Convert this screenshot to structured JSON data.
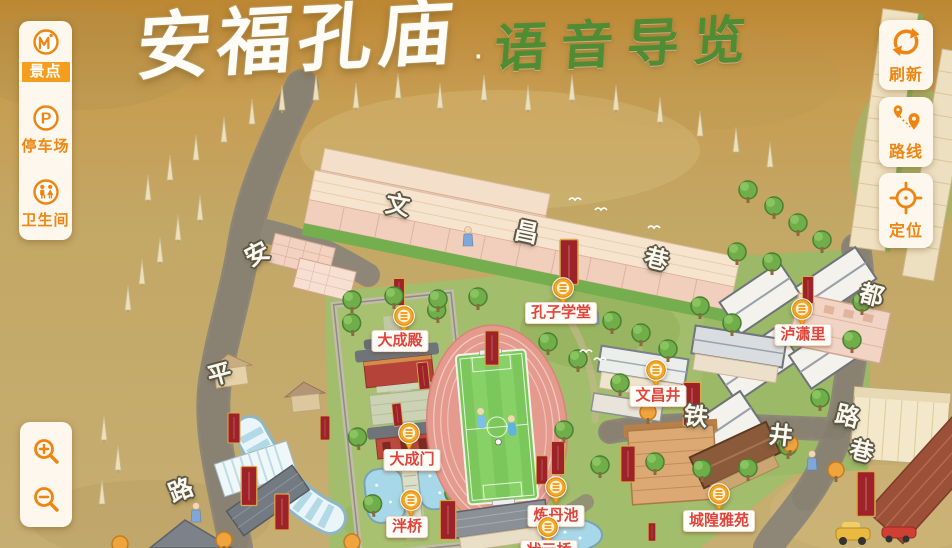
{
  "title": {
    "main": "安福孔庙",
    "separator": "·",
    "subtitle": "语音导览"
  },
  "left_toolbar": {
    "items": [
      {
        "label": "景点",
        "icon": "scenic-spot-icon",
        "active": true
      },
      {
        "label": "停车场",
        "icon": "parking-icon",
        "active": false
      },
      {
        "label": "卫生间",
        "icon": "restroom-icon",
        "active": false
      }
    ]
  },
  "right_toolbar": {
    "items": [
      {
        "label": "刷新",
        "icon": "refresh-icon"
      },
      {
        "label": "路线",
        "icon": "route-icon"
      },
      {
        "label": "定位",
        "icon": "locate-icon"
      }
    ]
  },
  "zoom_controls": {
    "items": [
      {
        "icon": "zoom-in-icon"
      },
      {
        "icon": "zoom-out-icon"
      }
    ]
  },
  "map": {
    "pois": [
      {
        "name": "大成殿",
        "marker_x": 404,
        "marker_y": 320,
        "label_x": 400,
        "label_y": 330
      },
      {
        "name": "孔子学堂",
        "marker_x": 563,
        "marker_y": 292,
        "label_x": 561,
        "label_y": 302
      },
      {
        "name": "大成门",
        "marker_x": 409,
        "marker_y": 437,
        "label_x": 412,
        "label_y": 449
      },
      {
        "name": "泮桥",
        "marker_x": 411,
        "marker_y": 504,
        "label_x": 407,
        "label_y": 516
      },
      {
        "name": "炼丹池",
        "marker_x": 556,
        "marker_y": 491,
        "label_x": 556,
        "label_y": 505
      },
      {
        "name": "状元桥",
        "marker_x": 548,
        "marker_y": 531,
        "label_x": 549,
        "label_y": 540
      },
      {
        "name": "文昌井",
        "marker_x": 656,
        "marker_y": 374,
        "label_x": 658,
        "label_y": 385
      },
      {
        "name": "泸潇里",
        "marker_x": 802,
        "marker_y": 313,
        "label_x": 803,
        "label_y": 324
      },
      {
        "name": "城隍雅苑",
        "marker_x": 719,
        "marker_y": 498,
        "label_x": 719,
        "label_y": 510
      }
    ],
    "street_chars": [
      {
        "ch": "文",
        "x": 398,
        "y": 203,
        "rot": 10
      },
      {
        "ch": "昌",
        "x": 527,
        "y": 230,
        "rot": 12
      },
      {
        "ch": "巷",
        "x": 657,
        "y": 257,
        "rot": 14
      },
      {
        "ch": "安",
        "x": 256,
        "y": 252,
        "rot": -28
      },
      {
        "ch": "平",
        "x": 219,
        "y": 372,
        "rot": -15
      },
      {
        "ch": "路",
        "x": 180,
        "y": 488,
        "rot": -22
      },
      {
        "ch": "都",
        "x": 872,
        "y": 293,
        "rot": 14
      },
      {
        "ch": "路",
        "x": 848,
        "y": 414,
        "rot": 14
      },
      {
        "ch": "巷",
        "x": 862,
        "y": 449,
        "rot": 14
      },
      {
        "ch": "铁",
        "x": 696,
        "y": 414,
        "rot": 6
      },
      {
        "ch": "井",
        "x": 781,
        "y": 433,
        "rot": 6
      }
    ]
  },
  "colors": {
    "accent": "#f08511",
    "active_item_bg": "#f59d1f",
    "poi_label_text": "#e2433a",
    "marker_orange": "#f5a623",
    "banner_red": "#9e2328",
    "title_green": "#4f8c33"
  }
}
